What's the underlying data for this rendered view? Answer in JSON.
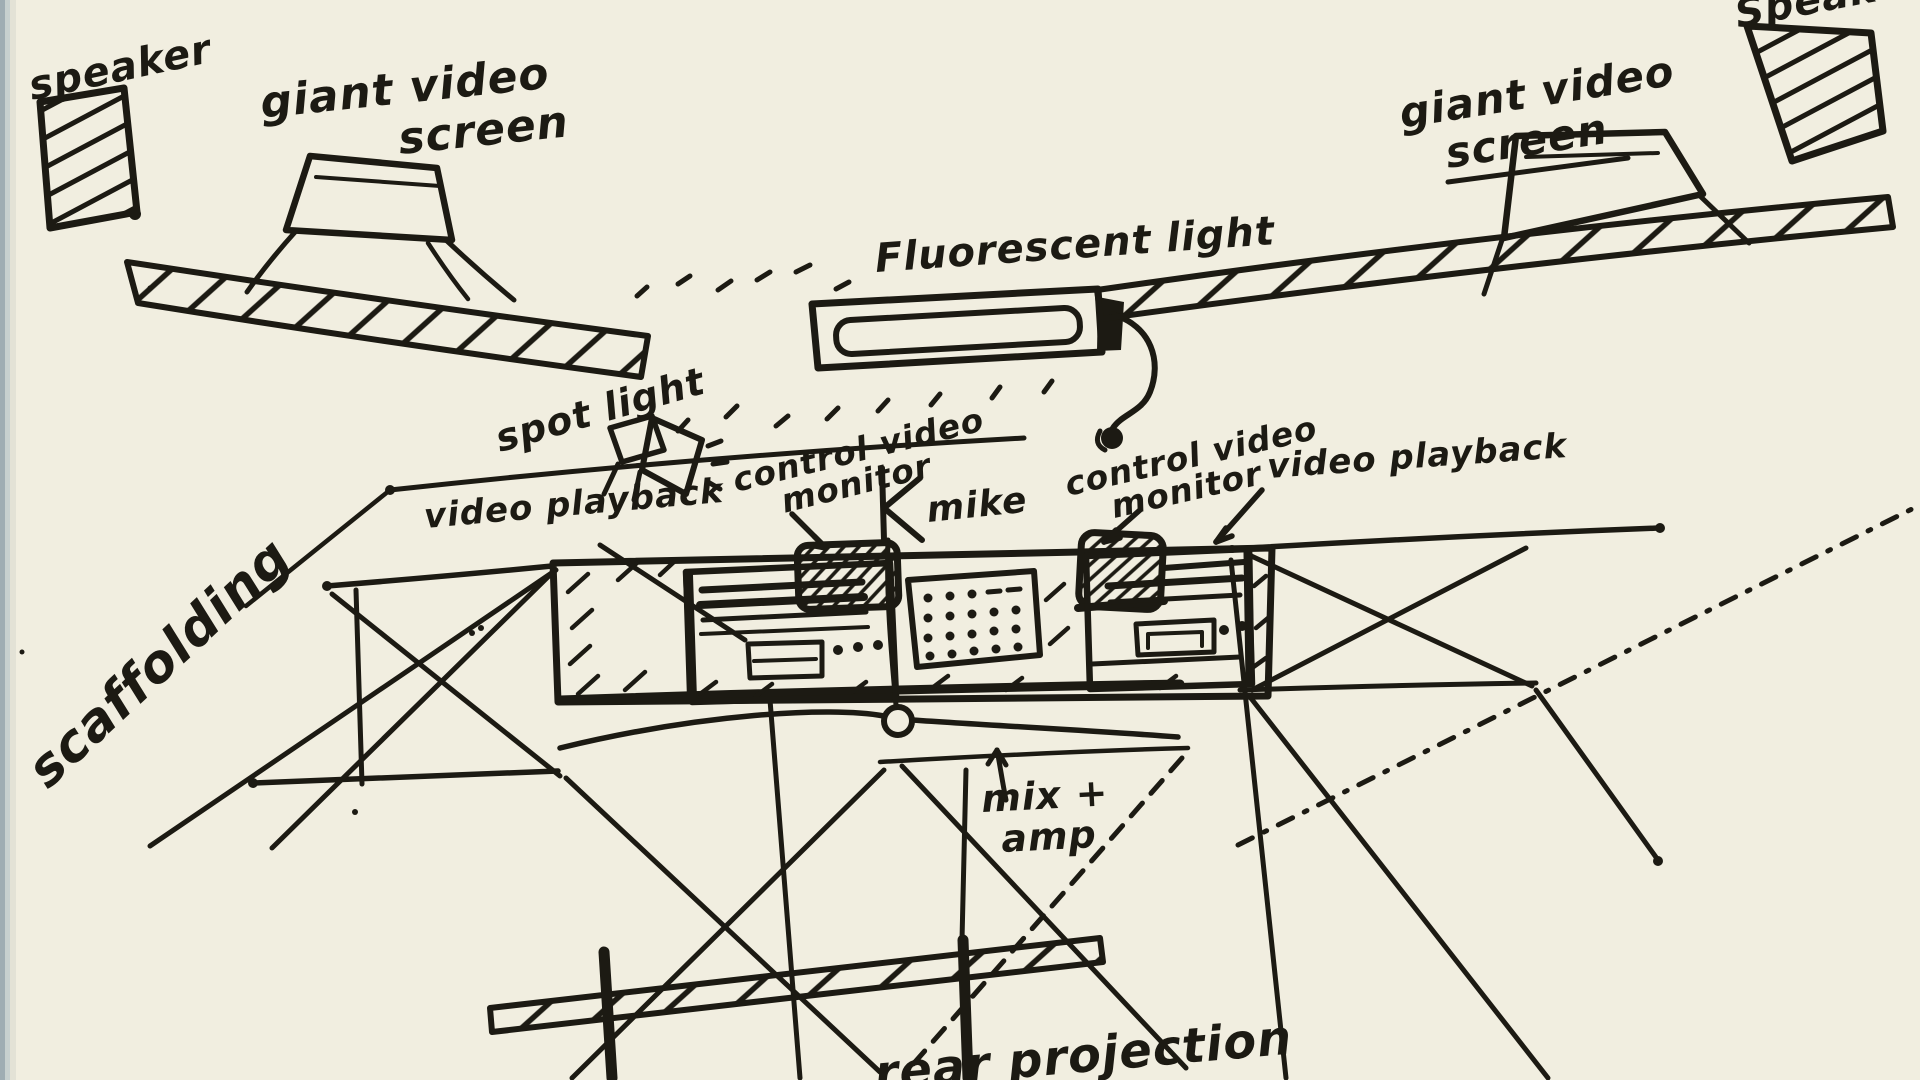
{
  "palette": {
    "paper": "#f1eee0",
    "ink": "#1c1a13",
    "page_edge": "#9fadb3"
  },
  "labels": {
    "speaker_left": "speaker",
    "speaker_right": "Speaker",
    "giant_screen_left_line1": "giant video",
    "giant_screen_left_line2": "screen",
    "giant_screen_right_line1": "giant video",
    "giant_screen_right_line2": "screen",
    "fluorescent_light": "Fluorescent light",
    "spot_light": "spot light",
    "video_playback_left": "video playback",
    "video_playback_right": "video playback",
    "control_monitor_left_line1": "control video",
    "control_monitor_left_line2": "monitor",
    "control_monitor_right_line1": "control video",
    "control_monitor_right_line2": "monitor",
    "mike": "mike",
    "mix_amp_line1": "mix +",
    "mix_amp_line2": "amp",
    "scaffolding": "scaffolding",
    "rear_projection": "rear projection"
  }
}
